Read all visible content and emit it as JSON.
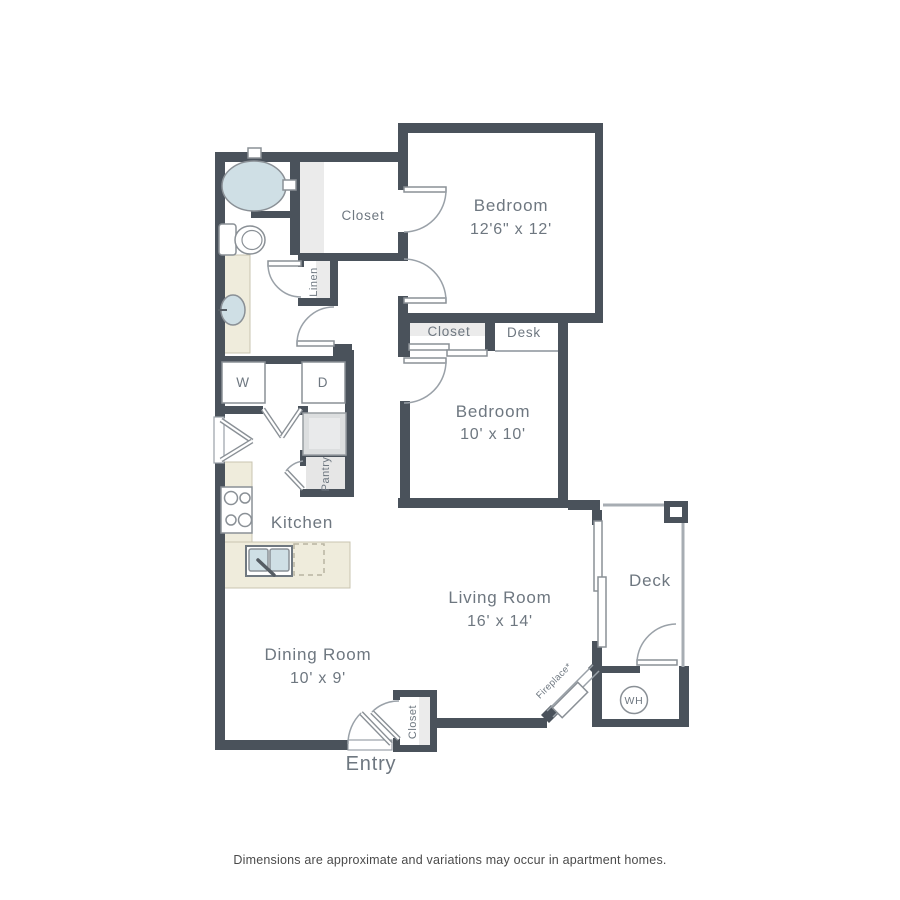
{
  "plan": {
    "rooms": {
      "bedroom_main": {
        "label": "Bedroom",
        "dims": "12'6\" x 12'"
      },
      "bedroom_second": {
        "label": "Bedroom",
        "dims": "10' x 10'"
      },
      "living_room": {
        "label": "Living Room",
        "dims": "16' x 14'"
      },
      "dining_room": {
        "label": "Dining Room",
        "dims": "10' x 9'"
      },
      "kitchen": {
        "label": "Kitchen"
      },
      "deck": {
        "label": "Deck"
      },
      "entry": {
        "label": "Entry"
      }
    },
    "areas": {
      "walk_in_closet": {
        "label": "Closet"
      },
      "bedroom_closet": {
        "label": "Closet"
      },
      "entry_closet": {
        "label": "Closet"
      },
      "linen": {
        "label": "Linen"
      },
      "pantry": {
        "label": "Pantry"
      },
      "desk": {
        "label": "Desk"
      },
      "fireplace": {
        "label": "Fireplace*"
      }
    },
    "appliances": {
      "washer": "W",
      "dryer": "D",
      "water_heater": "WH"
    },
    "footer": {
      "disclaimer": "Dimensions are approximate and variations may occur in apartment homes."
    },
    "colors": {
      "wall": "#4a525b",
      "counter": "#efecdc",
      "water_fixture": "#cfdfe5",
      "shelf": "#ebebeb",
      "label_text": "#6e7780"
    }
  }
}
